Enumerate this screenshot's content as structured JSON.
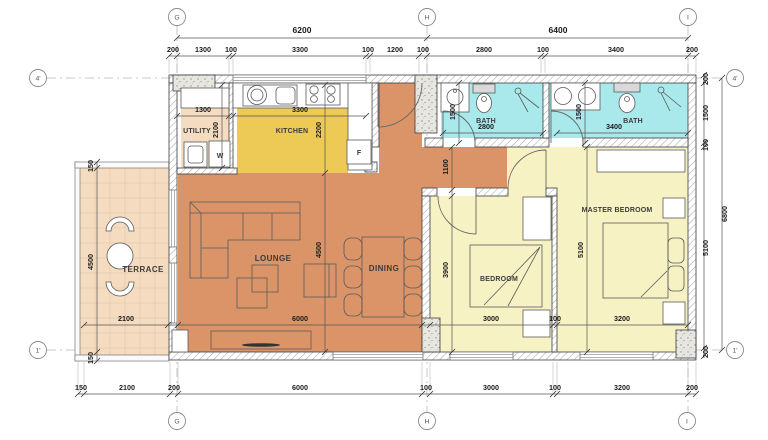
{
  "title": "Two Bedroom Apartment Floor Plan",
  "colors": {
    "floor-lounge": "#db9468",
    "floor-kitchen": "#edc955",
    "floor-bath": "#a9e8eb",
    "floor-bedroom": "#f6f2c4",
    "floor-terrace": "#f5dcc1",
    "wall-stroke": "#3d3d3d",
    "dim-color": "#1b1b1b",
    "room-label-color": "#3b3b3b",
    "grid-color": "#b9b9b9"
  },
  "grid": {
    "markers": [
      {
        "t": "G",
        "x": 177,
        "y": 17
      },
      {
        "t": "H",
        "x": 427,
        "y": 17
      },
      {
        "t": "I",
        "x": 688,
        "y": 17
      },
      {
        "t": "G",
        "x": 177,
        "y": 421
      },
      {
        "t": "H",
        "x": 427,
        "y": 421
      },
      {
        "t": "I",
        "x": 687,
        "y": 421
      },
      {
        "t": "4'",
        "x": 38,
        "y": 78
      },
      {
        "t": "1'",
        "x": 38,
        "y": 350
      },
      {
        "t": "4'",
        "x": 735,
        "y": 78
      },
      {
        "t": "1'",
        "x": 735,
        "y": 350
      }
    ]
  },
  "dimensions": {
    "labels": [
      {
        "t": "6200",
        "x": 302,
        "y": 33,
        "k": "dimL"
      },
      {
        "t": "6400",
        "x": 558,
        "y": 33,
        "k": "dimL"
      },
      {
        "t": "200",
        "x": 173,
        "y": 52
      },
      {
        "t": "1300",
        "x": 203,
        "y": 52
      },
      {
        "t": "100",
        "x": 231,
        "y": 52
      },
      {
        "t": "3300",
        "x": 300,
        "y": 52
      },
      {
        "t": "100",
        "x": 368,
        "y": 52
      },
      {
        "t": "1200",
        "x": 395,
        "y": 52
      },
      {
        "t": "100",
        "x": 423,
        "y": 52
      },
      {
        "t": "2800",
        "x": 484,
        "y": 52
      },
      {
        "t": "100",
        "x": 543,
        "y": 52
      },
      {
        "t": "3400",
        "x": 616,
        "y": 52
      },
      {
        "t": "200",
        "x": 692,
        "y": 52
      },
      {
        "t": "150",
        "x": 81,
        "y": 390
      },
      {
        "t": "2100",
        "x": 127,
        "y": 390
      },
      {
        "t": "200",
        "x": 174,
        "y": 390
      },
      {
        "t": "6000",
        "x": 300,
        "y": 390
      },
      {
        "t": "100",
        "x": 426,
        "y": 390
      },
      {
        "t": "3000",
        "x": 491,
        "y": 390
      },
      {
        "t": "100",
        "x": 555,
        "y": 390
      },
      {
        "t": "3200",
        "x": 622,
        "y": 390
      },
      {
        "t": "200",
        "x": 692,
        "y": 390
      },
      {
        "t": "2100",
        "x": 126,
        "y": 321
      },
      {
        "t": "6000",
        "x": 300,
        "y": 321
      },
      {
        "t": "3000",
        "x": 491,
        "y": 321
      },
      {
        "t": "100",
        "x": 555,
        "y": 321
      },
      {
        "t": "3200",
        "x": 622,
        "y": 321
      },
      {
        "t": "1300",
        "x": 203,
        "y": 112
      },
      {
        "t": "3300",
        "x": 300,
        "y": 112
      },
      {
        "t": "2800",
        "x": 486,
        "y": 129
      },
      {
        "t": "3400",
        "x": 614,
        "y": 129
      },
      {
        "t": "200",
        "x": 708,
        "y": 79,
        "r": 1
      },
      {
        "t": "1500",
        "x": 708,
        "y": 113,
        "r": 1
      },
      {
        "t": "100",
        "x": 708,
        "y": 145,
        "r": 1
      },
      {
        "t": "5100",
        "x": 708,
        "y": 248,
        "r": 1
      },
      {
        "t": "200",
        "x": 708,
        "y": 352,
        "r": 1
      },
      {
        "t": "6800",
        "x": 727,
        "y": 214,
        "r": 1
      },
      {
        "t": "150",
        "x": 93,
        "y": 166,
        "r": 1
      },
      {
        "t": "4500",
        "x": 93,
        "y": 262,
        "r": 1
      },
      {
        "t": "150",
        "x": 93,
        "y": 358,
        "r": 1
      },
      {
        "t": "2100",
        "x": 218,
        "y": 130,
        "r": 1
      },
      {
        "t": "2200",
        "x": 321,
        "y": 130,
        "r": 1
      },
      {
        "t": "4500",
        "x": 321,
        "y": 250,
        "r": 1
      },
      {
        "t": "1500",
        "x": 455,
        "y": 112,
        "r": 1
      },
      {
        "t": "1500",
        "x": 581,
        "y": 112,
        "r": 1
      },
      {
        "t": "1100",
        "x": 448,
        "y": 167,
        "r": 1
      },
      {
        "t": "3900",
        "x": 448,
        "y": 270,
        "r": 1
      },
      {
        "t": "5100",
        "x": 583,
        "y": 250,
        "r": 1
      }
    ]
  },
  "rooms": {
    "labels": [
      {
        "t": "TERRACE",
        "x": 143,
        "y": 272
      },
      {
        "t": "UTILITY",
        "x": 197,
        "y": 133,
        "k": "roomS"
      },
      {
        "t": "KITCHEN",
        "x": 292,
        "y": 133,
        "k": "roomS"
      },
      {
        "t": "BATH",
        "x": 486,
        "y": 123,
        "k": "roomS"
      },
      {
        "t": "BATH",
        "x": 633,
        "y": 123,
        "k": "roomS"
      },
      {
        "t": "LOUNGE",
        "x": 273,
        "y": 261
      },
      {
        "t": "DINING",
        "x": 384,
        "y": 271
      },
      {
        "t": "BEDROOM",
        "x": 499,
        "y": 281,
        "k": "roomS"
      },
      {
        "t": "MASTER BEDROOM",
        "x": 617,
        "y": 212,
        "k": "roomS"
      },
      {
        "t": "W",
        "x": 220,
        "y": 158,
        "k": "appl"
      },
      {
        "t": "F",
        "x": 359,
        "y": 155,
        "k": "appl"
      }
    ]
  }
}
